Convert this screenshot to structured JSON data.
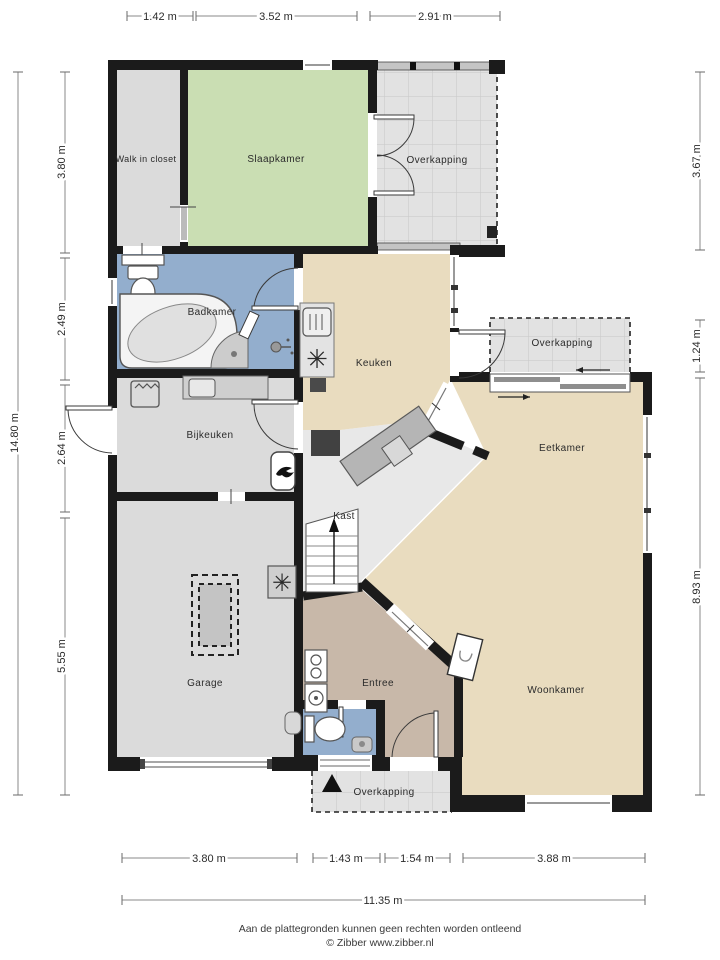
{
  "rooms": {
    "walk_in_closet": "Walk in closet",
    "slaapkamer": "Slaapkamer",
    "overkapping_top": "Overkapping",
    "badkamer": "Badkamer",
    "keuken": "Keuken",
    "overkapping_right": "Overkapping",
    "bijkeuken": "Bijkeuken",
    "eetkamer": "Eetkamer",
    "kast": "Kast",
    "garage": "Garage",
    "entree": "Entree",
    "woonkamer": "Woonkamer",
    "overkapping_bottom": "Overkapping"
  },
  "dimensions": {
    "top": [
      "1.42 m",
      "3.52 m",
      "2.91 m"
    ],
    "left_total": "14.80 m",
    "left": [
      "3.80 m",
      "2.49 m",
      "2.64 m",
      "5.55 m"
    ],
    "right": [
      "3.67 m",
      "1.24 m",
      "8.93 m"
    ],
    "bottom": [
      "3.80 m",
      "1.43 m",
      "1.54 m",
      "3.88 m"
    ],
    "bottom_total": "11.35 m"
  },
  "footer": {
    "disclaimer": "Aan de plattegronden kunnen geen rechten worden ontleend",
    "copyright": "© Zibber www.zibber.nl"
  },
  "icons": {
    "fan_glyph": "✳",
    "burner_glyph": "✳"
  },
  "colors": {
    "wall": "#1b1b1b",
    "bedroom": "#cadeb3",
    "bathroom": "#93aecd",
    "kitchen": "#e9dcbf",
    "entry": "#c8b8a9",
    "utility": "#dbdbdb",
    "porch": "#e2e2e2",
    "hall": "#e8e8e8",
    "counter": "#b5b5b5"
  }
}
